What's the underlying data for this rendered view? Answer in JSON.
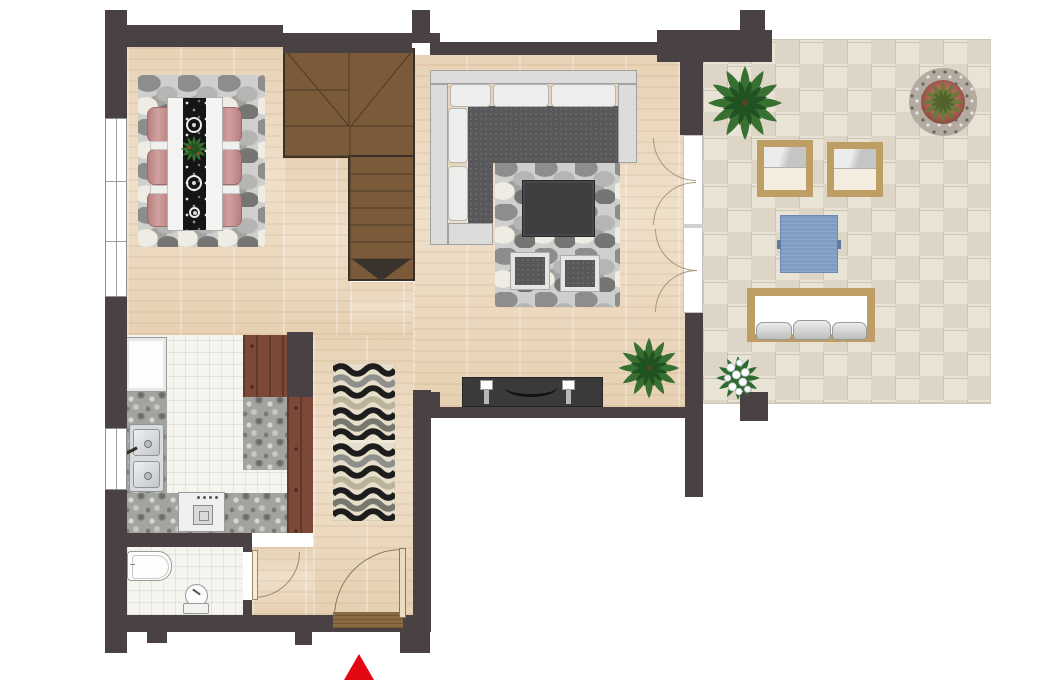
{
  "meta": {
    "view": "top-down-floor-plan",
    "canvas_width": 1043,
    "canvas_height": 680
  },
  "palette": {
    "wall": "#4a4145",
    "wood_floor": "#ecd9bf",
    "stair_wood": "#7b5a39",
    "kitchen_tile": "#f6f4ee",
    "granite_counter": "#a3a3a0",
    "cabinet_wood": "#7c4938",
    "patio_stone": "#e9e3d6",
    "pebble_rug": "#cfcfcd",
    "runner_rug_black": "#151515",
    "dining_chair_rose": "#c08484",
    "sofa_seat_gray": "#58585a",
    "sofa_frame_gray": "#dcdcda",
    "outdoor_frame_tan": "#bf9e66",
    "outdoor_cushion_cream": "#f3ecdf",
    "outdoor_table_blue": "#7f9dc2",
    "plant_green": "#377030",
    "entrance_arrow_red": "#e30613"
  },
  "rooms": {
    "dining_area": {
      "items": [
        {
          "name": "pebble-area-rug",
          "count": 1
        },
        {
          "name": "dining-table",
          "count": 1
        },
        {
          "name": "black-table-runner",
          "count": 1
        },
        {
          "name": "runner-medallion",
          "count": 3
        },
        {
          "name": "dining-chair",
          "count": 6
        },
        {
          "name": "centerpiece-plant",
          "count": 1
        },
        {
          "name": "window-pane",
          "count": 3
        }
      ]
    },
    "living_room": {
      "items": [
        {
          "name": "sectional-sofa",
          "count": 1
        },
        {
          "name": "back-cushion",
          "count": 5
        },
        {
          "name": "pebble-area-rug",
          "count": 1
        },
        {
          "name": "coffee-table",
          "count": 1
        },
        {
          "name": "ottoman-pouf",
          "count": 2
        },
        {
          "name": "media-console",
          "count": 1
        },
        {
          "name": "candle-holder",
          "count": 2
        },
        {
          "name": "potted-palm",
          "count": 1
        },
        {
          "name": "french-door-leaf",
          "count": 4
        }
      ]
    },
    "staircase": {
      "items": [
        {
          "name": "winder-stairs",
          "count": 1
        },
        {
          "name": "direction-triangle",
          "count": 1
        }
      ]
    },
    "kitchen": {
      "items": [
        {
          "name": "refrigerator",
          "count": 1
        },
        {
          "name": "double-sink",
          "count": 1
        },
        {
          "name": "faucet",
          "count": 1
        },
        {
          "name": "cooktop-stove",
          "count": 1
        },
        {
          "name": "granite-countertop",
          "count": 3
        },
        {
          "name": "wood-cabinet",
          "count": 2
        },
        {
          "name": "window-pane",
          "count": 1
        }
      ]
    },
    "hallway": {
      "items": [
        {
          "name": "wave-runner-rug",
          "count": 1
        },
        {
          "name": "front-door",
          "count": 1
        },
        {
          "name": "doormat",
          "count": 1
        }
      ]
    },
    "bathroom": {
      "items": [
        {
          "name": "bathtub",
          "count": 1
        },
        {
          "name": "toilet",
          "count": 1
        },
        {
          "name": "interior-door",
          "count": 1
        }
      ]
    },
    "patio": {
      "items": [
        {
          "name": "lounge-chair",
          "count": 2
        },
        {
          "name": "blue-side-table",
          "count": 1
        },
        {
          "name": "outdoor-bench",
          "count": 1
        },
        {
          "name": "bench-pillow",
          "count": 3
        },
        {
          "name": "round-planter",
          "count": 1
        },
        {
          "name": "potted-palm",
          "count": 1
        },
        {
          "name": "white-flower-plant",
          "count": 1
        }
      ]
    }
  },
  "entrance": {
    "marker": "red-arrow",
    "direction": "up"
  }
}
